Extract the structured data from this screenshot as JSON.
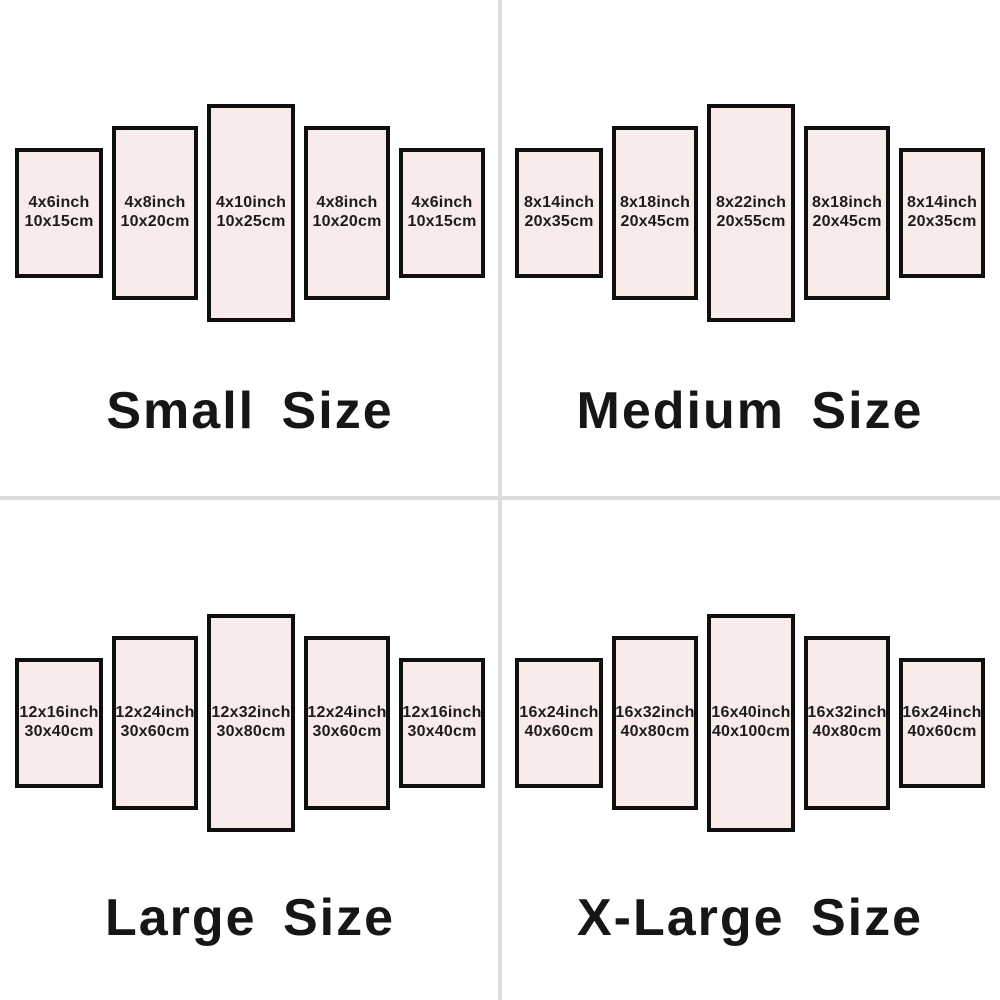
{
  "page": {
    "background": "#ffffff"
  },
  "style": {
    "panel_fill": "#f9ebea",
    "panel_border": "#0f0f0f",
    "divider_color": "#dcdcdc",
    "title_color": "#161616",
    "label_color": "#1c1c1c"
  },
  "quadrants": [
    {
      "title": "Small Size",
      "panels": [
        {
          "inch": "4x6inch",
          "cm": "10x15cm"
        },
        {
          "inch": "4x8inch",
          "cm": "10x20cm"
        },
        {
          "inch": "4x10inch",
          "cm": "10x25cm"
        },
        {
          "inch": "4x8inch",
          "cm": "10x20cm"
        },
        {
          "inch": "4x6inch",
          "cm": "10x15cm"
        }
      ]
    },
    {
      "title": "Medium Size",
      "panels": [
        {
          "inch": "8x14inch",
          "cm": "20x35cm"
        },
        {
          "inch": "8x18inch",
          "cm": "20x45cm"
        },
        {
          "inch": "8x22inch",
          "cm": "20x55cm"
        },
        {
          "inch": "8x18inch",
          "cm": "20x45cm"
        },
        {
          "inch": "8x14inch",
          "cm": "20x35cm"
        }
      ]
    },
    {
      "title": "Large Size",
      "panels": [
        {
          "inch": "12x16inch",
          "cm": "30x40cm"
        },
        {
          "inch": "12x24inch",
          "cm": "30x60cm"
        },
        {
          "inch": "12x32inch",
          "cm": "30x80cm"
        },
        {
          "inch": "12x24inch",
          "cm": "30x60cm"
        },
        {
          "inch": "12x16inch",
          "cm": "30x40cm"
        }
      ]
    },
    {
      "title": "X-Large Size",
      "panels": [
        {
          "inch": "16x24inch",
          "cm": "40x60cm"
        },
        {
          "inch": "16x32inch",
          "cm": "40x80cm"
        },
        {
          "inch": "16x40inch",
          "cm": "40x100cm"
        },
        {
          "inch": "16x32inch",
          "cm": "40x80cm"
        },
        {
          "inch": "16x24inch",
          "cm": "40x60cm"
        }
      ]
    }
  ]
}
